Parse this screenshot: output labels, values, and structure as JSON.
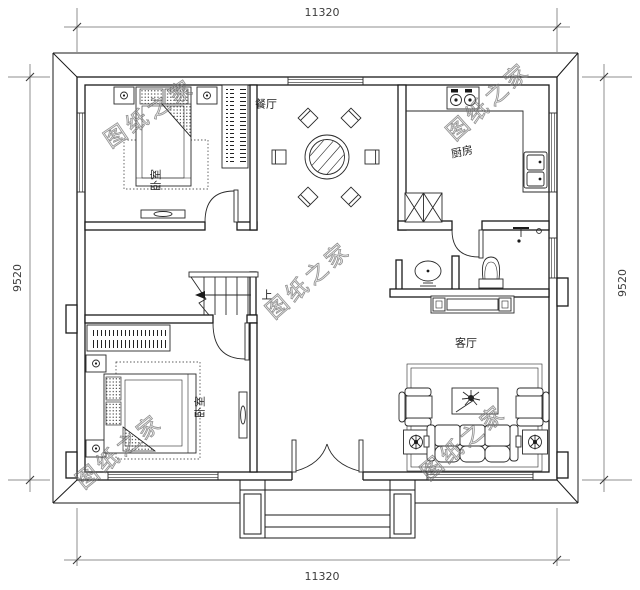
{
  "dimensions": {
    "top": "11320",
    "bottom": "11320",
    "left": "9520",
    "right": "9520"
  },
  "rooms": {
    "dining": "餐厅",
    "kitchen": "厨房",
    "living": "客厅",
    "bedroom_top": "卧室",
    "bedroom_bottom": "卧室"
  },
  "stairs": {
    "up_label": "上"
  },
  "watermark": {
    "text": "图纸之家",
    "color": "#8f8f8f"
  },
  "colors": {
    "wall_line": "#1a1a1a",
    "furniture_line": "#2a2a2a",
    "dimension_line": "#666666",
    "background": "#ffffff"
  }
}
